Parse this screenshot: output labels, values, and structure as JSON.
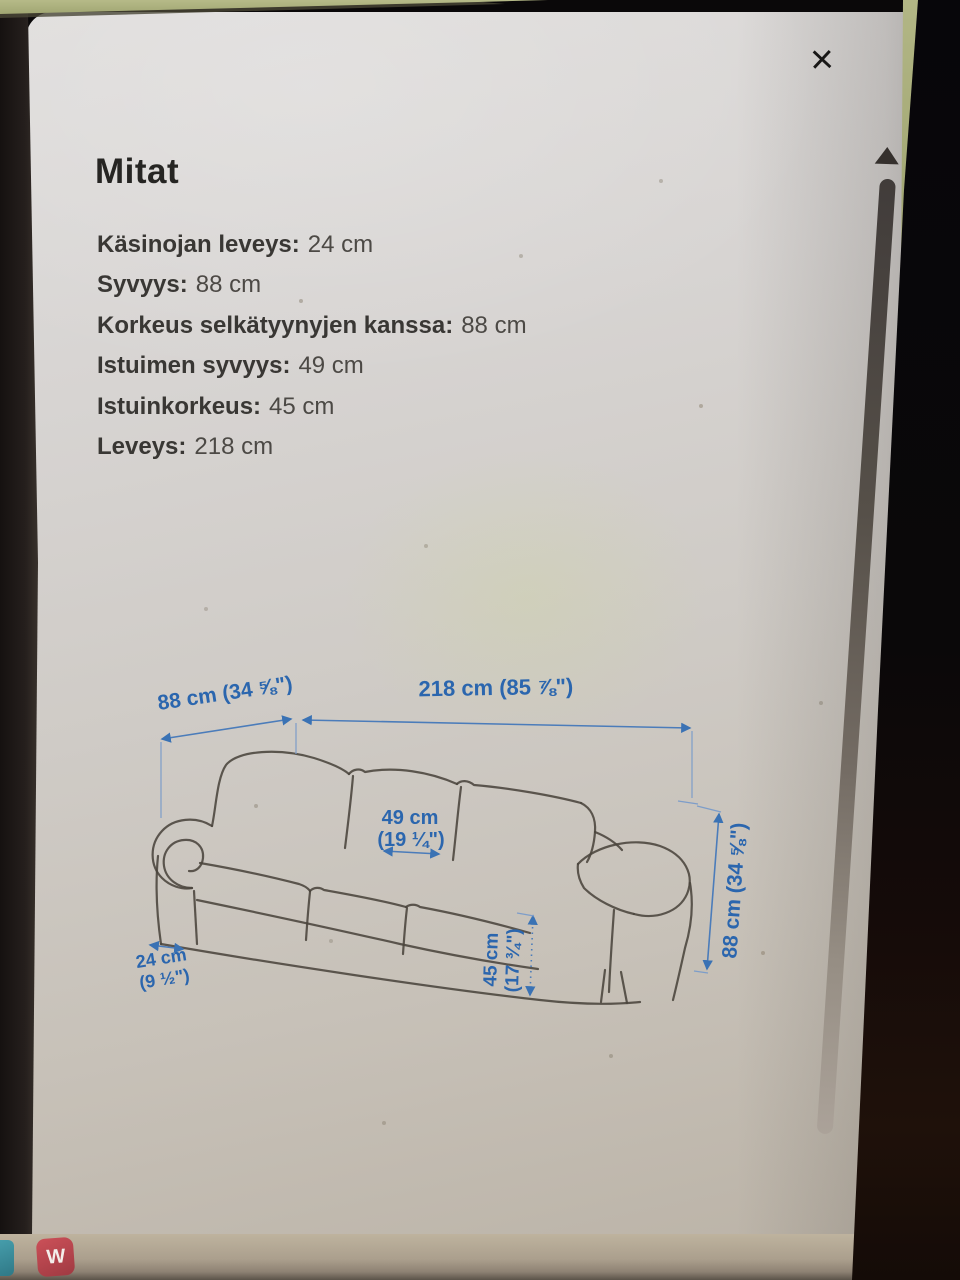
{
  "modal": {
    "title": "Mitat",
    "close_glyph": "×",
    "dimensions": [
      {
        "label": "Käsinojan leveys:",
        "value": "24 cm"
      },
      {
        "label": "Syvyys:",
        "value": "88 cm"
      },
      {
        "label": "Korkeus selkätyynyjen kanssa:",
        "value": "88 cm"
      },
      {
        "label": "Istuimen syvyys:",
        "value": "49 cm"
      },
      {
        "label": "Istuinkorkeus:",
        "value": "45 cm"
      },
      {
        "label": "Leveys:",
        "value": "218 cm"
      }
    ]
  },
  "diagram": {
    "depth_label": "88 cm (34 ⅝\")",
    "width_label": "218 cm (85 ⅞\")",
    "seat_depth_line1": "49 cm",
    "seat_depth_line2": "(19 ¼\")",
    "seat_height_line1": "45 cm",
    "seat_height_line2": "(17 ¾\")",
    "arm_width_line1": "24 cm",
    "arm_width_line2": "(9 ½\")",
    "height_label": "88 cm (34 ⅝\")"
  },
  "taskbar": {
    "icons": [
      {
        "name": "teal-app",
        "label": ""
      },
      {
        "name": "w-app",
        "label": "W"
      }
    ]
  },
  "colors": {
    "dimension_blue": "#2b66ae",
    "sketch_gray": "#4a443c",
    "bezel_olive": "#aeb27f",
    "icon_red": "#bf4750",
    "icon_teal": "#3f96a5"
  }
}
